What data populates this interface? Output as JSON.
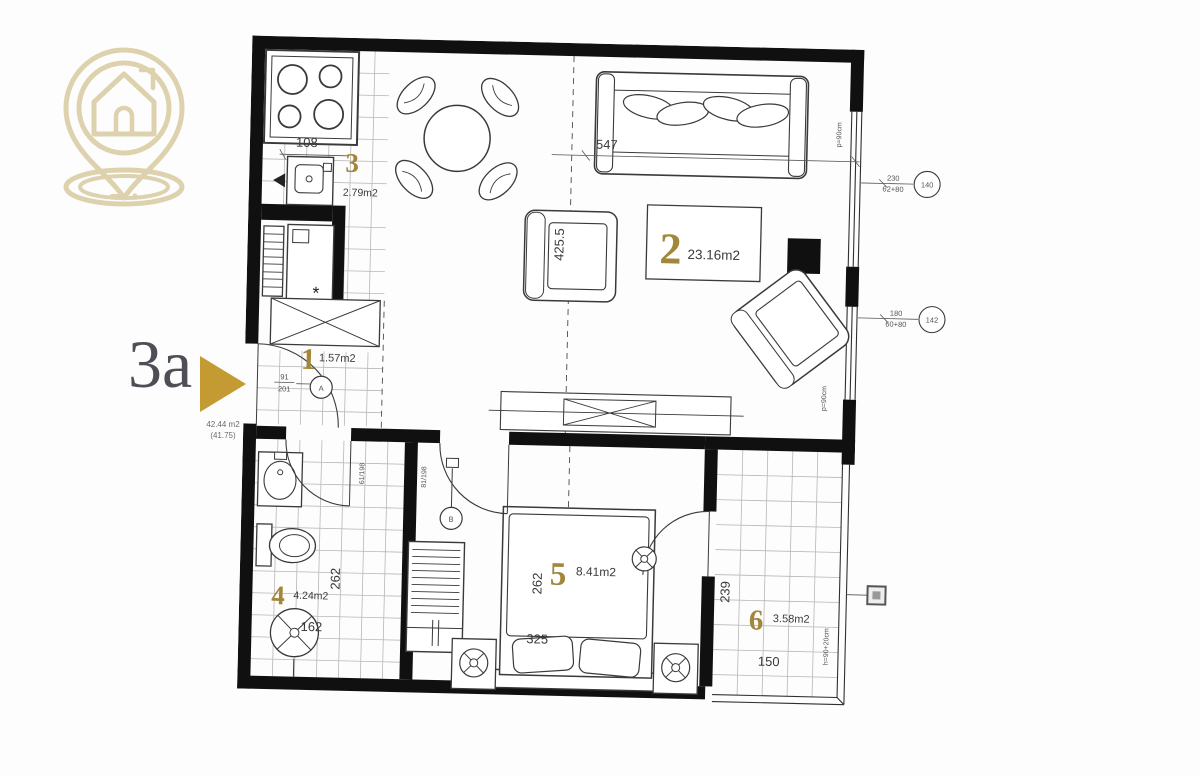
{
  "brand": {
    "logo": "house-location-pin"
  },
  "colors": {
    "brand_beige": "#ddd2ad",
    "accent_gold": "#c49a33",
    "room_number_gold": "#a2863a"
  },
  "unit": {
    "label": "3a",
    "area_total": "42.44 m2",
    "area_net": "(41.75)"
  },
  "rooms": {
    "r1": {
      "num": "1",
      "area": "1.57m2"
    },
    "r2": {
      "num": "2",
      "area": "23.16m2"
    },
    "r3": {
      "num": "3",
      "area": "2.79m2"
    },
    "r4": {
      "num": "4",
      "area": "4.24m2"
    },
    "r5": {
      "num": "5",
      "area": "8.41m2"
    },
    "r6": {
      "num": "6",
      "area": "3.58m2"
    }
  },
  "dims": {
    "kitchen_counter": "108",
    "living_width": "547",
    "living_depth": "425.5",
    "bath_depth": "262",
    "bath_width": "162",
    "bedroom_depth": "262",
    "bed_width": "325",
    "balcony_depth": "239",
    "balcony_width": "150"
  },
  "annotations": {
    "parapet_top": "p=90cm",
    "parapet_side": "p=90cm",
    "balcony_rail": "h=90+20cm",
    "door_a": "A",
    "door_b": "B",
    "door_a_size_top": "91",
    "door_a_size_bottom": "201",
    "door_b_size": "81/198",
    "bath_door_size": "61/198",
    "window1_dim_top": "230",
    "window1_dim_bottom": "62+80",
    "window1_tag": "140",
    "window2_dim_top": "180",
    "window2_dim_bottom": "60+80",
    "window2_tag": "142",
    "fridge_mark": "*"
  }
}
